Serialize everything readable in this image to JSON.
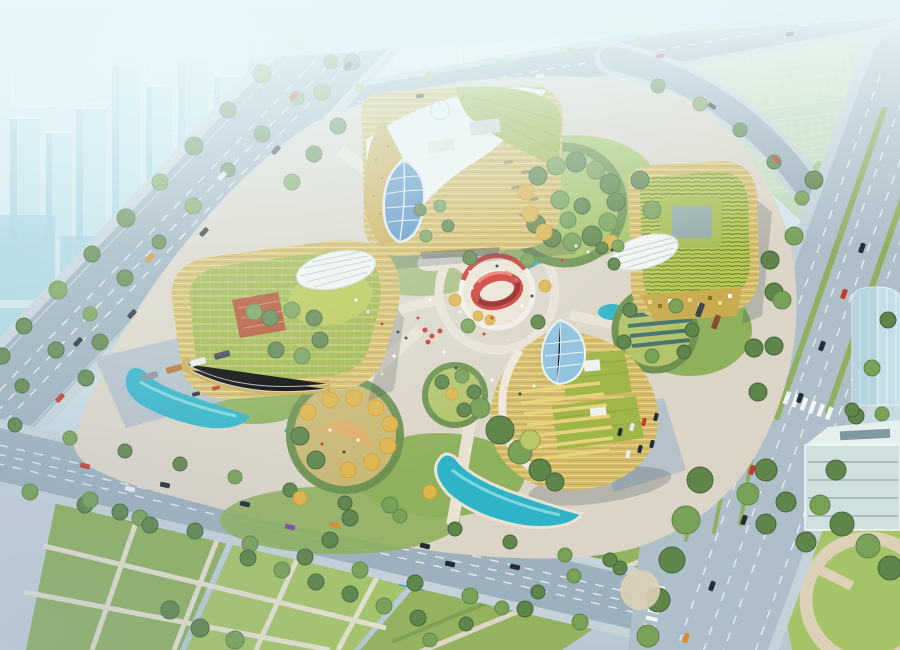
{
  "scene": {
    "type": "aerial architectural rendering",
    "description": "Bird's-eye daytime visualization of a cultural campus: four curved golden buildings arranged around a circular landscaped park with a red ribbon-ring sculpture at its center, ringed by tree-lined boulevards, a wide highway with crosswalks, turquoise pools, and a hazy pale-cyan city skyline fading into the distance.",
    "center_feature": "red möbius ribbon sculpture on a round paved plaza with a red-and-white ring wall",
    "buildings": [
      {
        "id": "north-building",
        "label": "North hall",
        "features": "gold perforated facade, sweeping white roof, leaf-shaped blue glass atrium, small rooftop dome, green roof strip"
      },
      {
        "id": "west-building",
        "label": "West hall",
        "features": "gold banded facade, rooftop pergola garden, red-brown roof terrace, white ribbed oval canopy, kidney-shaped pool"
      },
      {
        "id": "east-building",
        "label": "East hall",
        "features": "gold pixelated facade, rooftop courtyard garden, white striped oval skylight"
      },
      {
        "id": "south-building",
        "label": "South spiral pavilion",
        "features": "spiral green roofs with vent boxes, stepped yellow terraces, leaf-shaped glass skylight, turquoise lagoon"
      }
    ],
    "landscape": [
      "circular tree gardens (green and autumn-yellow)",
      "radial pedestrian paths",
      "cyan water channels",
      "lawn grid with row of blue reflecting pools",
      "street tree rows",
      "tiny pedestrians on plazas"
    ],
    "roads": [
      "west boulevard with planted median",
      "north road",
      "east multi-lane highway with zebra crossings and grass medians",
      "south boulevard",
      "northeast connector road",
      "large paved intersection"
    ],
    "background": [
      "high-rise residential towers north-west",
      "institutional campus with round pond and orange tree allees north-east",
      "glass box office south-east",
      "cylindrical glass tower on east edge",
      "white atmospheric haze over the horizon"
    ]
  },
  "palette": {
    "bg_top": "#dff0f4",
    "bg_mid": "#cfe3ea",
    "bg_bottom": "#b7c8d3",
    "city_block": "#bfe1ea",
    "city_block_shade": "#a3cfdd",
    "city_glass": "#9fd0dd",
    "city_white": "#e8f3f5",
    "tree_pale": "#9cc489",
    "campus_lawn": "#b4d7a4",
    "pond_blue": "#a8dde6",
    "road": "#9db0bd",
    "road_light": "#aebfca",
    "sidewalk": "#c6d2da",
    "lane_mark": "#f5f8fa",
    "park_pave": "#dcd5c7",
    "path_light": "#e9e2d3",
    "plaza_pave": "#ece4d4",
    "lawn": "#8fb05c",
    "lawn_bright": "#a5c468",
    "hedge": "#6d9150",
    "tree_dark": "#44663a",
    "tree_mid": "#5f854a",
    "tree_light": "#79a157",
    "tree_yellow": "#ddb54d",
    "tree_orange": "#d9982f",
    "water": "#2fb3c7",
    "water_light": "#8fdde4",
    "pool_blue": "#3f9fd0",
    "pool_blue_light": "#7cc4e0",
    "gold": "#d6bd6b",
    "gold_light": "#ecd98f",
    "gold_dark": "#ab8f45",
    "roof_white": "#f3f5f1",
    "roof_green": "#9fb648",
    "roof_green2": "#b9c84f",
    "roof_red": "#b5502f",
    "glass_blue": "#8fc1dd",
    "glass_deep": "#5b93c4",
    "red_ring": "#d0372e",
    "red_deep": "#8e1f1c",
    "red_accent": "#c43b2f",
    "car_dark": "#232e39",
    "car_red": "#c23b2e",
    "car_orange": "#df8b2b",
    "car_white": "#e9eef2",
    "car_purple": "#7b4fa0",
    "shadow": "rgba(45,65,75,0.22)"
  }
}
